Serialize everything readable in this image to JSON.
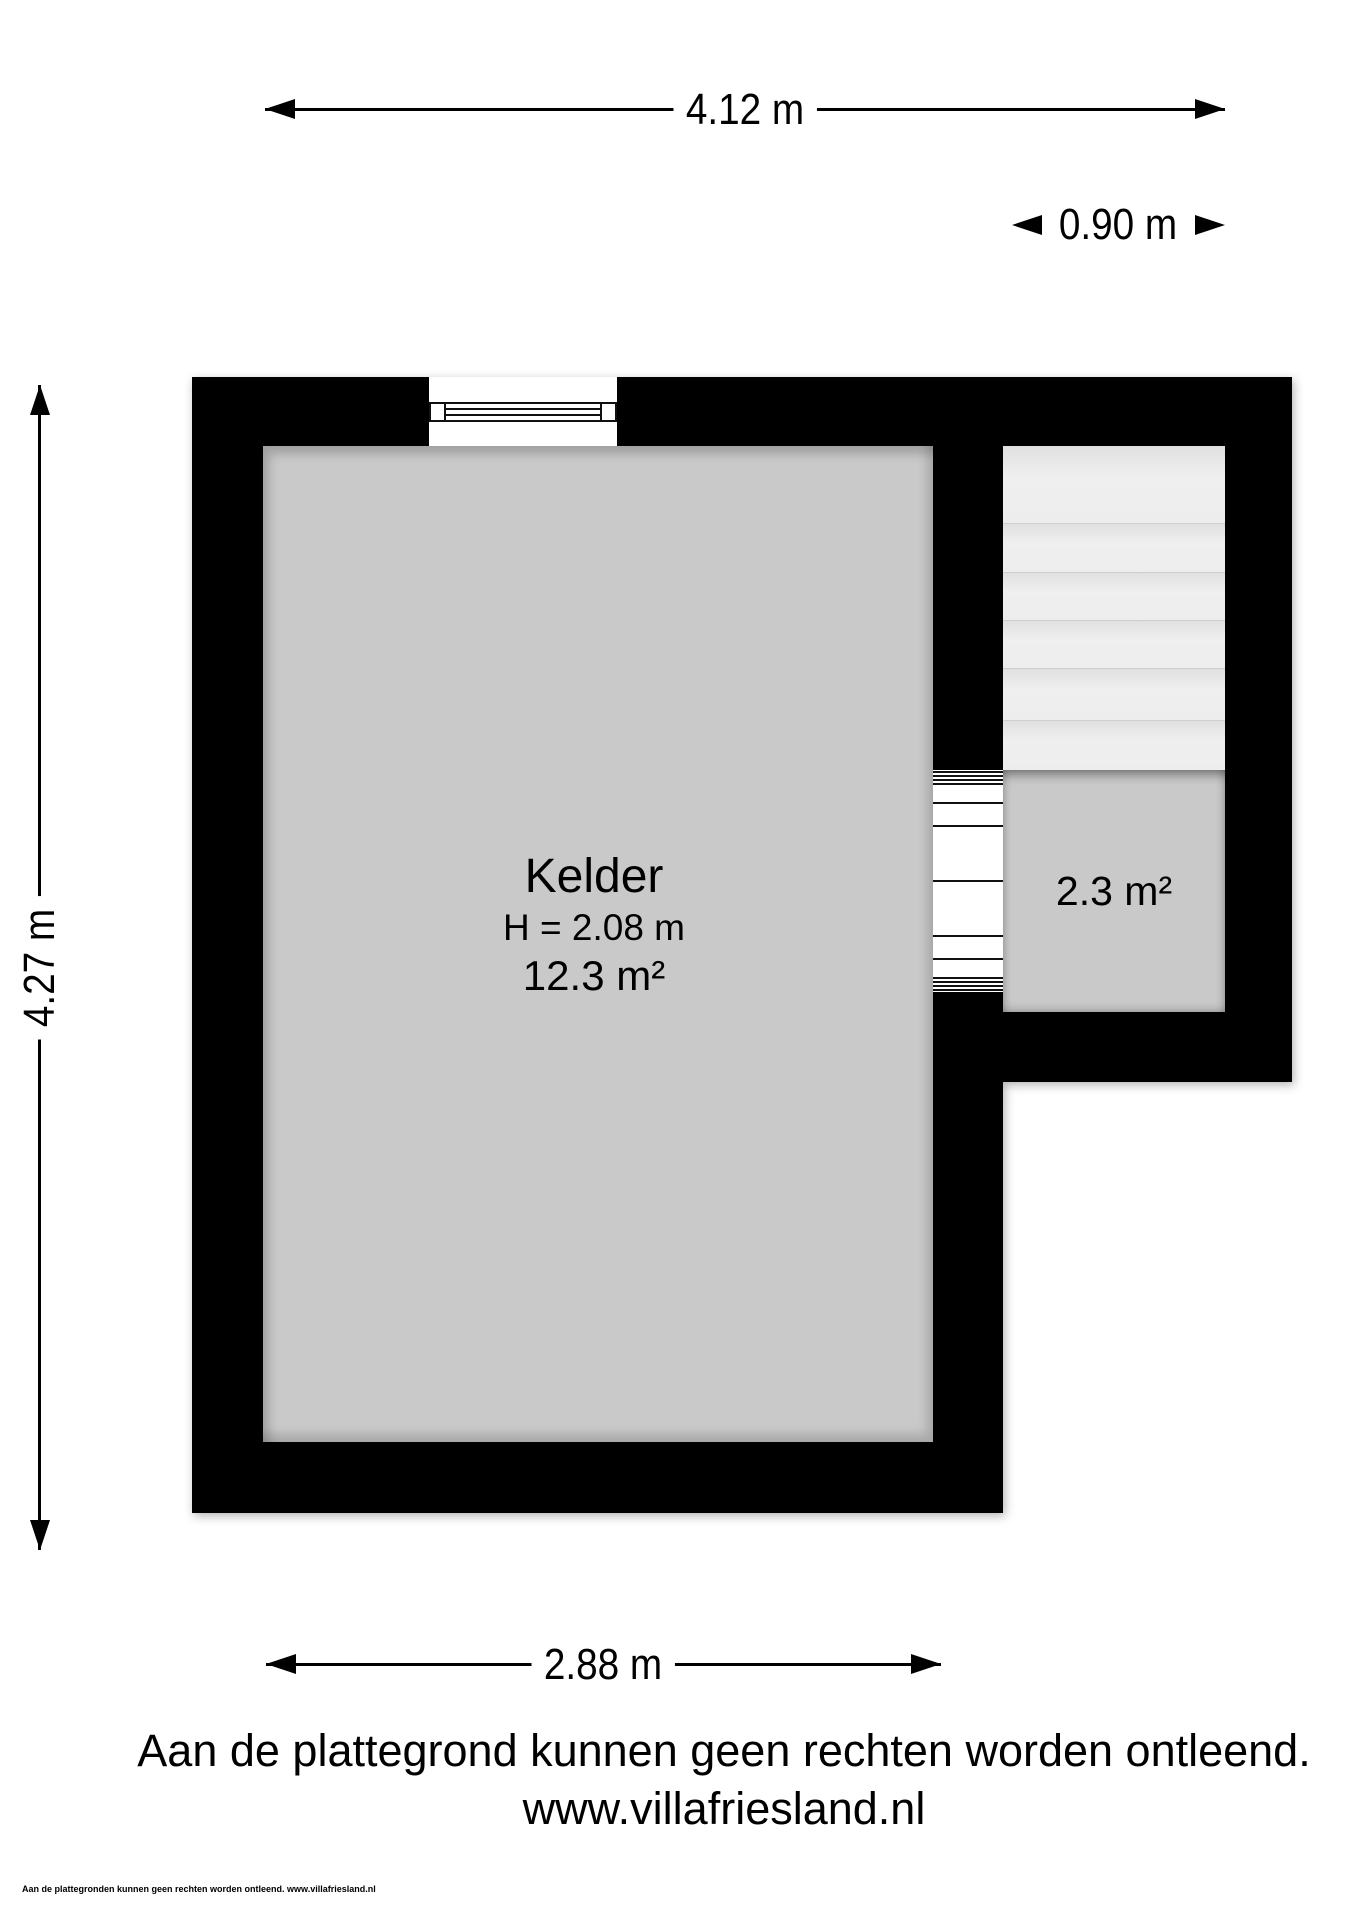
{
  "dimensions": {
    "width_total": "4.12 m",
    "stairwell_width": "0.90 m",
    "height_total": "4.27 m",
    "width_kelder": "2.88 m"
  },
  "rooms": {
    "kelder": {
      "name": "Kelder",
      "ceiling_height": "H = 2.08 m",
      "area": "12.3 m²"
    },
    "stairwell": {
      "area": "2.3 m²",
      "treads": 6
    }
  },
  "footer": {
    "disclaimer": "Aan de plattegrond kunnen geen rechten worden ontleend.",
    "website": "www.villafriesland.nl",
    "fine_print": "Aan de plattegronden kunnen geen rechten worden ontleend. www.villafriesland.nl"
  },
  "colors": {
    "wall": "#000000",
    "floor": "#c9c9c9",
    "stair-tread": "#ededed",
    "dimension": "#000000"
  }
}
